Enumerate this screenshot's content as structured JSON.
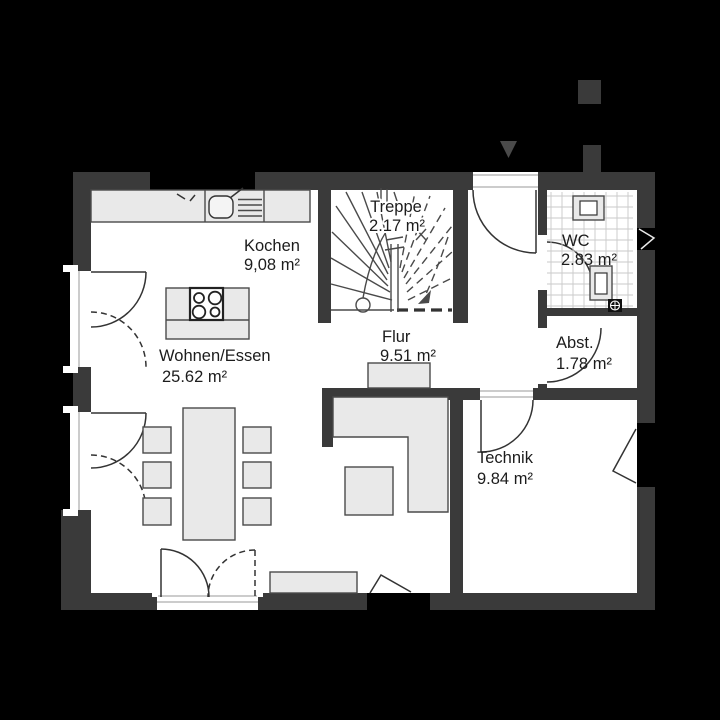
{
  "colors": {
    "bg": "#000000",
    "wall": "#3a3a3a",
    "room": "#ffffff",
    "furniture": "#e9e9e9",
    "outline": "#4a4a4a",
    "line": "#333333",
    "text": "#1c1c1c"
  },
  "rooms": {
    "kochen": {
      "name": "Kochen",
      "area": "9,08 m²"
    },
    "treppe": {
      "name": "Treppe",
      "area": "2.17 m²"
    },
    "wc": {
      "name": "WC",
      "area": "2.83 m²"
    },
    "flur": {
      "name": "Flur",
      "area": "9.51 m²"
    },
    "abstellraum": {
      "name": "Abst.",
      "area": "1.78 m²"
    },
    "wohnen_essen": {
      "name": "Wohnen/Essen",
      "area": "25.62 m²"
    },
    "technik": {
      "name": "Technik",
      "area": "9.84 m²"
    }
  }
}
